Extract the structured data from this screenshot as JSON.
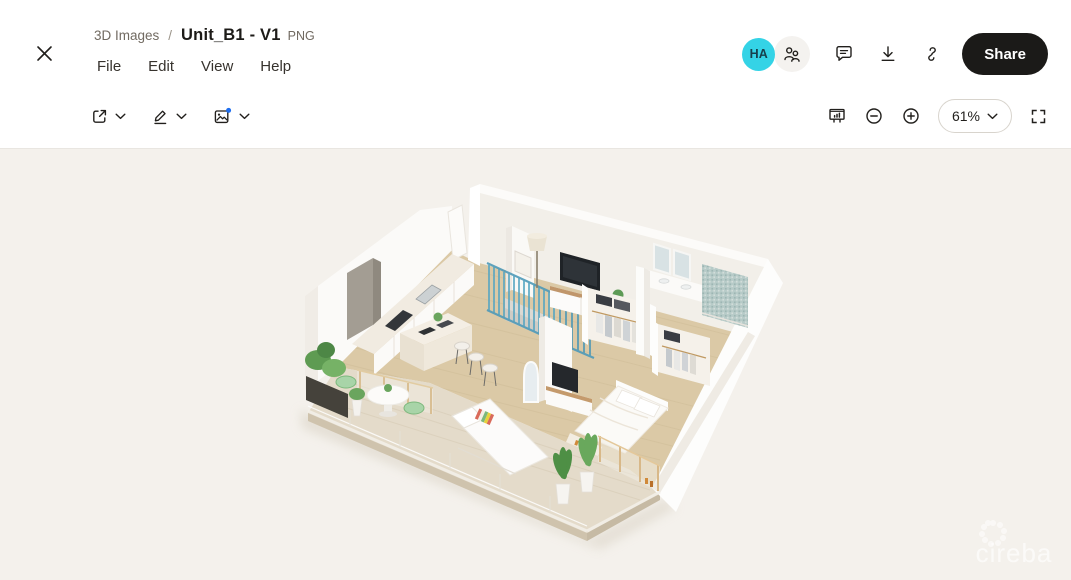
{
  "header": {
    "breadcrumb": {
      "folder": "3D Images",
      "separator": "/",
      "filename": "Unit_B1 - V1",
      "filetype": "PNG"
    },
    "menu": {
      "items": [
        {
          "label": "File"
        },
        {
          "label": "Edit"
        },
        {
          "label": "View"
        },
        {
          "label": "Help"
        }
      ]
    },
    "actions": {
      "avatar_initials": "HA",
      "share_label": "Share"
    }
  },
  "toolbar": {
    "zoom_level": "61%"
  },
  "canvas": {
    "watermark": "cireba"
  },
  "icons": {
    "close": "close-icon",
    "members": "people-icon",
    "comment": "comment-icon",
    "download": "download-icon",
    "copy_link": "link-icon",
    "open_in": "open-in-icon",
    "annotate": "pencil-icon",
    "edit_image": "image-edit-icon",
    "present": "present-icon",
    "zoom_out": "minus-circle-icon",
    "zoom_in": "plus-circle-icon",
    "fullscreen": "fullscreen-icon",
    "dropdown": "chevron-down-icon"
  },
  "colors": {
    "header_bg": "#ffffff",
    "canvas_bg": "#f4f1ec",
    "avatar_bg": "#34d3e6",
    "share_button_bg": "#1b1a18",
    "share_button_text": "#ffffff",
    "new_badge_dot": "#1e6ef0",
    "partition_teal": "#57a6c2",
    "dining_table_blue": "#3e6b92",
    "floor_wood": "#dbc9a6",
    "plant_green": "#5e9b52"
  }
}
